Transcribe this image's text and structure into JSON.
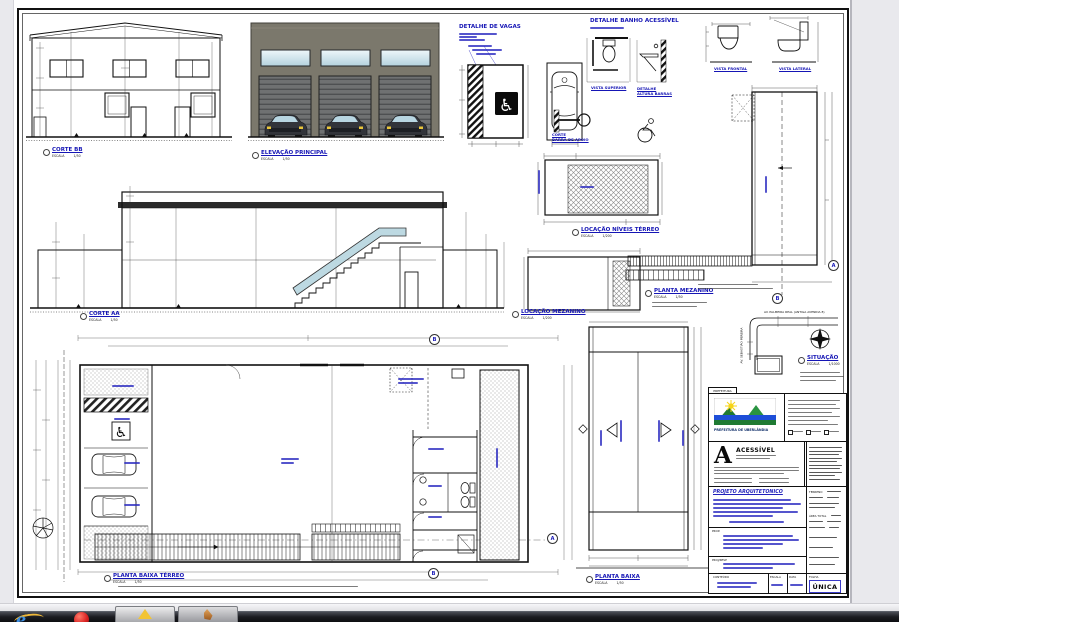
{
  "window": {
    "description": "Remote desktop viewer showing an architectural drawing sheet",
    "page_bg": "#e9e9ed"
  },
  "views": {
    "corte_bb": {
      "title": "CORTE BB",
      "scale_label": "ESCALA",
      "scale": "1/50"
    },
    "elevacao_principal": {
      "title": "ELEVAÇÃO PRINCIPAL",
      "scale_label": "ESCALA",
      "scale": "1/50"
    },
    "detalhe_vagas": {
      "title": "DETALHE DE VAGAS"
    },
    "detalhe_banho": {
      "title": "DETALHE BANHO ACESSÍVEL"
    },
    "vista_superior": {
      "title": "VISTA SUPERIOR"
    },
    "detalhe_altura": {
      "title": "DETALHE",
      "subtitle": "ALTURA BARRAS"
    },
    "corte_barra": {
      "title": "CORTE",
      "subtitle": "BARRA DE APOIO"
    },
    "vista_frontal": {
      "title": "VISTA FRONTAL"
    },
    "vista_lateral": {
      "title": "VISTA LATERAL"
    },
    "corte_aa": {
      "title": "CORTE AA",
      "scale_label": "ESCALA",
      "scale": "1/50"
    },
    "locacao_terreo": {
      "title": "LOCAÇÃO NÍVEIS TÉRREO",
      "scale_label": "ESCALA",
      "scale": "1/200"
    },
    "locacao_mezanino": {
      "title": "LOCAÇÃO MEZANINO",
      "scale_label": "ESCALA",
      "scale": "1/200"
    },
    "planta_mezanino": {
      "title": "PLANTA MEZANINO",
      "scale_label": "ESCALA",
      "scale": "1/50"
    },
    "planta_baixa_terreo": {
      "title": "PLANTA BAIXA TÉRREO",
      "scale_label": "ESCALA",
      "scale": "1/50"
    },
    "planta_baixa": {
      "title": "PLANTA BAIXA",
      "scale_label": "ESCALA",
      "scale": "1/50"
    },
    "situacao": {
      "title": "SITUAÇÃO",
      "scale_label": "ESCALA",
      "scale": "1/1000"
    }
  },
  "annotations": {
    "street_horizontal": "AV. PALMEIRA REAL (ANTIGA AVENIDA 8)",
    "street_vertical": "AV. SEBASTIÃO PEREIRA"
  },
  "markers": {
    "a": "A",
    "b": "B"
  },
  "title_block": {
    "tab": "PREFEITURA",
    "agency": "PREFEITURA DE UBERLÂNDIA",
    "stamp": "ACESSÍVEL",
    "project_title": "PROJETO ARQUITETONICO",
    "prop_label": "PROP.",
    "resp_label": "PROJ/RESP",
    "conteudo_label": "CONTEÚDO",
    "escala_label": "ESCALA",
    "data_label": "DATA",
    "folha_label": "FOLHA",
    "folha_value": "ÚNICA",
    "terreno_label": "TERRENO",
    "area_total_label": "ÁREA TOTAL"
  },
  "taskbar": {
    "icons": [
      {
        "name": "internet-explorer"
      },
      {
        "name": "red-orb-app"
      },
      {
        "name": "yellow-triangle-app"
      },
      {
        "name": "orange-app"
      }
    ]
  },
  "colors": {
    "label_blue": "#1515b5",
    "facade": "#7b786c",
    "glass": "#cfe3ec",
    "door": "#6f7172",
    "glass_rail": "#b9d7e0",
    "viewer_bg": "#e9e9ed",
    "taskbar": "#17181c"
  }
}
